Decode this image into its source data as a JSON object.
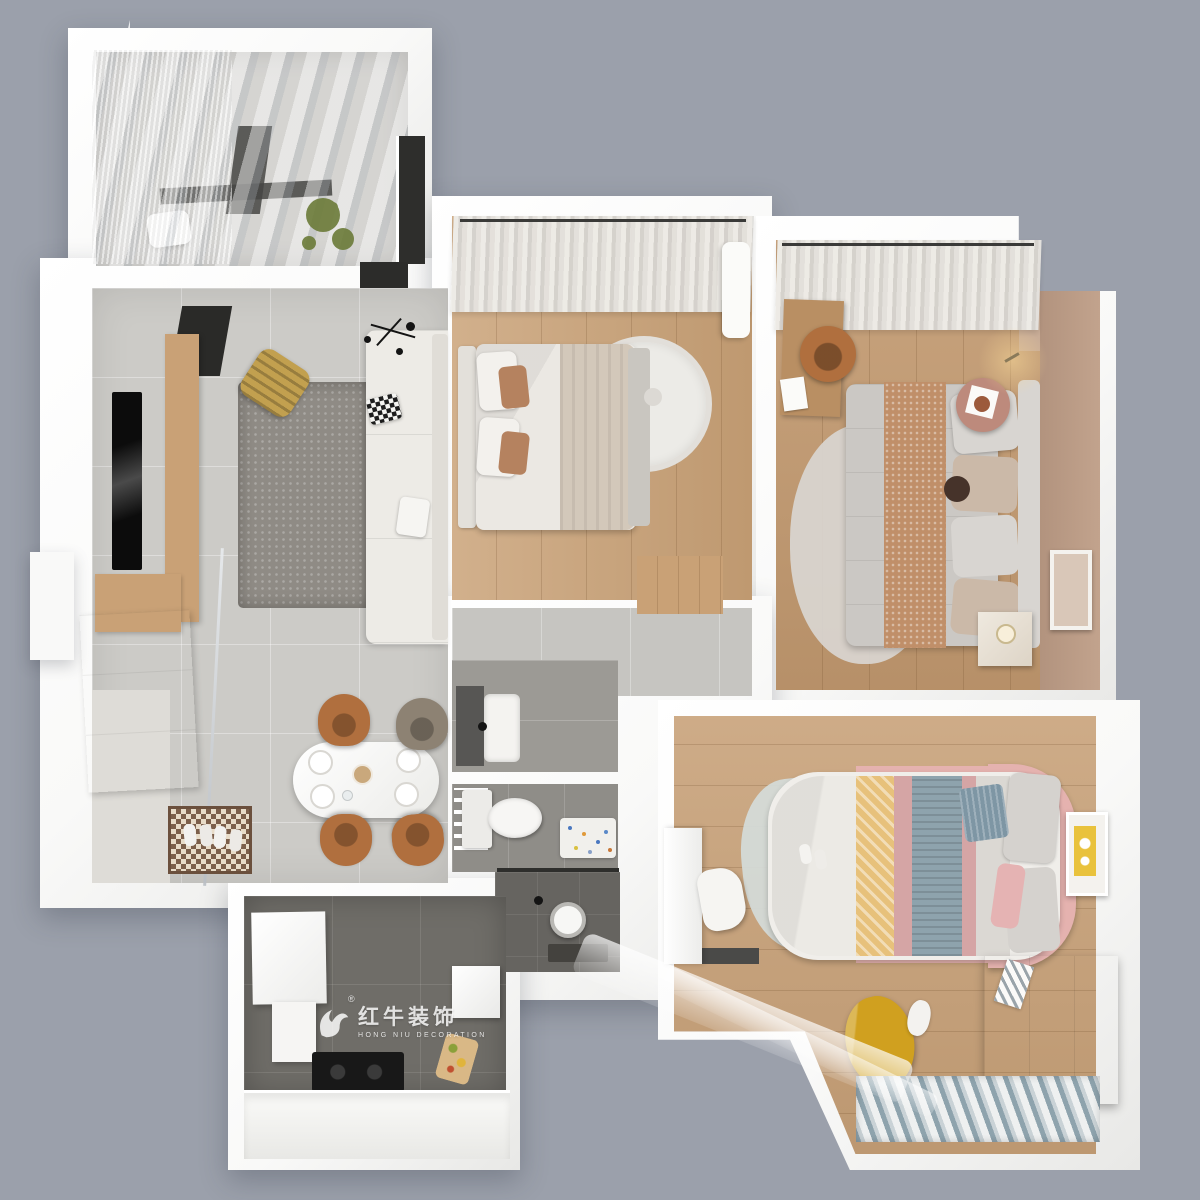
{
  "scene": {
    "type": "3d-floor-plan-render",
    "view": "top-down isometric",
    "description": "Photorealistic 3D top-down render of a furnished apartment floor plan on a gray background"
  },
  "watermark": {
    "brand_cn": "红牛装饰",
    "brand_en": "HONG NIU DECORATION",
    "registered": "®",
    "icon": "bull-logo-icon"
  },
  "rooms": [
    {
      "name": "balcony",
      "position": "top-left",
      "features": [
        "glass-roof",
        "sheer-curtains",
        "washing-machine",
        "hanging-plant",
        "dark-window-panel"
      ]
    },
    {
      "name": "living-room",
      "position": "left",
      "features": [
        "wall-mounted-tv",
        "wood-tv-console",
        "gray-shag-rug",
        "white-corner-sofa",
        "checkered-pillow",
        "slatted-mustard-lounge-chair",
        "black-spider-ceiling-lamp",
        "glass-partition"
      ]
    },
    {
      "name": "dining-area",
      "position": "center-left",
      "features": [
        "white-oval-table",
        "four-place-settings",
        "caramel-dining-chairs",
        "checkered-entry-doormat",
        "slippers",
        "white-shoe-cabinet",
        "wood-sideboard"
      ]
    },
    {
      "name": "second-bedroom",
      "position": "top-center",
      "features": [
        "double-bed-white-bedding",
        "brown-accent-pillows",
        "round-cream-rug",
        "window-curtains",
        "white-bench"
      ]
    },
    {
      "name": "master-bedroom",
      "position": "top-right",
      "features": [
        "double-bed-gray-bedding",
        "tan-textured-throw",
        "wood-desk",
        "leather-desk-chair",
        "round-terracotta-side-table",
        "nightstand-with-lamp",
        "wall-art-frame",
        "wall-sconce-glow",
        "taupe-accent-wall",
        "window-curtains"
      ]
    },
    {
      "name": "bathroom",
      "position": "center",
      "features": [
        "dark-vanity-counter",
        "white-sink",
        "toilet",
        "towel-rack",
        "dotted-bath-mat",
        "walk-in-shower",
        "shower-head",
        "dark-tile-floor"
      ]
    },
    {
      "name": "kitchen",
      "position": "bottom-left",
      "features": [
        "white-wall-cabinets",
        "black-cooktop",
        "white-counter",
        "fridge",
        "cutting-board-with-vegetables",
        "dark-tile-floor"
      ]
    },
    {
      "name": "kids-bedroom",
      "position": "bottom-right",
      "features": [
        "pink-framed-bed",
        "striped-duvet-yellow-blue-pink",
        "blue-checked-pillow",
        "organic-gray-rug",
        "study-desk",
        "white-desk-chair",
        "white-dresser",
        "yellow-bean-bag",
        "plush-toy",
        "yellow-wall-art",
        "window-with-curtains"
      ]
    }
  ],
  "palette": {
    "bg": "#9ba0ab",
    "wall": "#f9f9f8",
    "wallShade": "#e8e8e6",
    "tile": "#cccbc7",
    "tileHall": "#c6c5c1",
    "entry": "#dedcd7",
    "woodBed2": "#c9a176",
    "woodMaster": "#c2996f",
    "woodKids": "#c7a077",
    "plankLine": "rgba(110,75,40,.22)",
    "pinkWall": "#b2937e",
    "rug": "#8f8b85",
    "rugLight": "#ecebe7",
    "masterRug": "#d9d6d1",
    "kidsRug": "#d4dad7",
    "sofa": "#edebe6",
    "sofaShade": "#e0ddd7",
    "bedWhite": "#ebe8e3",
    "throwBeige": "#d3c8ba",
    "pillowBrown": "#b5825f",
    "mustard": "#c2a04f",
    "caramel": "#b06f3e",
    "oliveChair": "#8d8273",
    "duvetGray": "#cbc8c4",
    "throwTan": "#c08f69",
    "sideTable": "#bd8a7c",
    "poufBrown": "#46332a",
    "darkTileKitchen": "#6f6d68",
    "bathTile": "#9c9a95",
    "toiletTile": "#8f8d88",
    "showerTile": "#666460",
    "dark": "#2b2b29",
    "plant": "#6e7d3c",
    "glow": "rgba(246,214,150,.55)",
    "yellowArt": "#e9c23c",
    "beanYellow": "#d0a01f",
    "pinkFrame": "#e5b2af",
    "stripeYellow": "#e7c17b",
    "stripeBlue": "#8ea3ad",
    "stripePink": "#d5a5a5",
    "sheetGray": "#dbd8d3",
    "wm": "rgba(255,255,255,.82)"
  }
}
